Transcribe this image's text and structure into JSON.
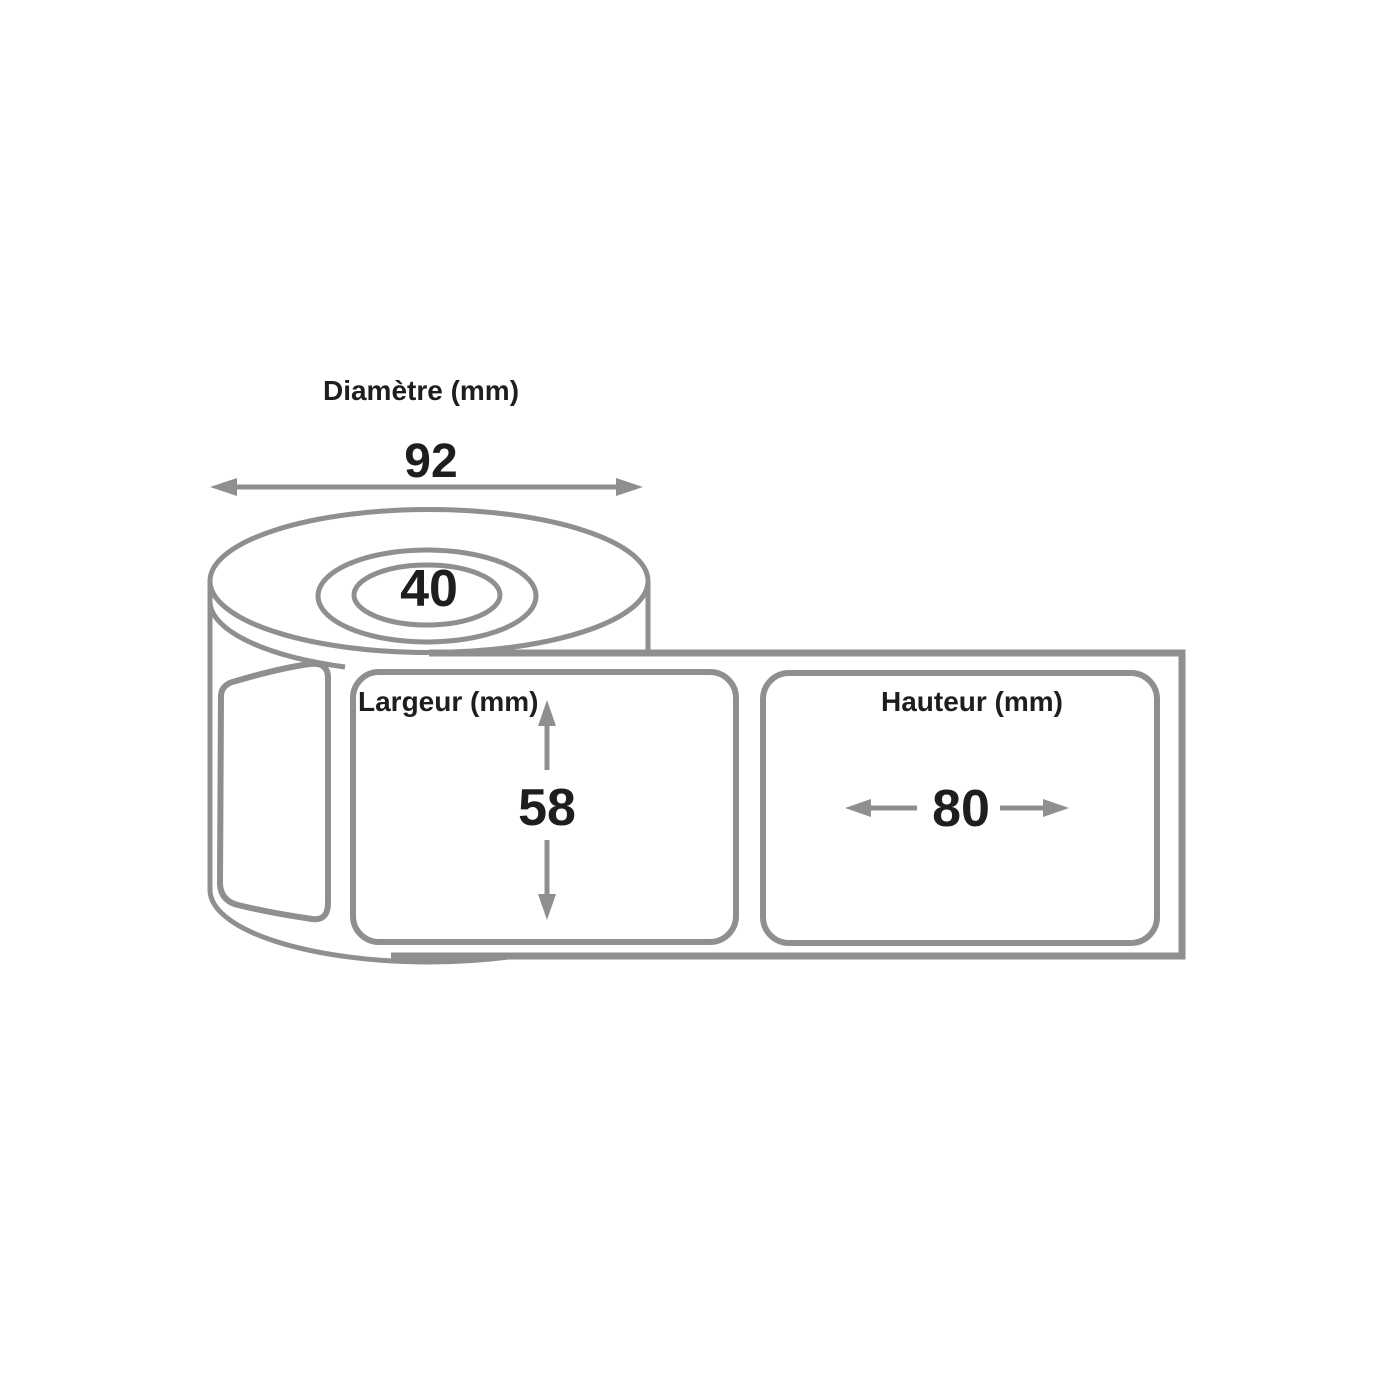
{
  "page": {
    "background_color": "#ffffff"
  },
  "diagram": {
    "type": "label-roll-dimension-drawing",
    "colors": {
      "line": "#8f8f8f",
      "arrow": "#8f8f8f",
      "text": "#1e1e1e",
      "background": "#ffffff"
    },
    "roll": {
      "core_value": "40"
    },
    "annotations": {
      "diameter": {
        "label": "Diamètre (mm)",
        "value": "92"
      },
      "width": {
        "label": "Largeur (mm)",
        "value": "58"
      },
      "height": {
        "label": "Hauteur (mm)",
        "value": "80"
      }
    }
  }
}
